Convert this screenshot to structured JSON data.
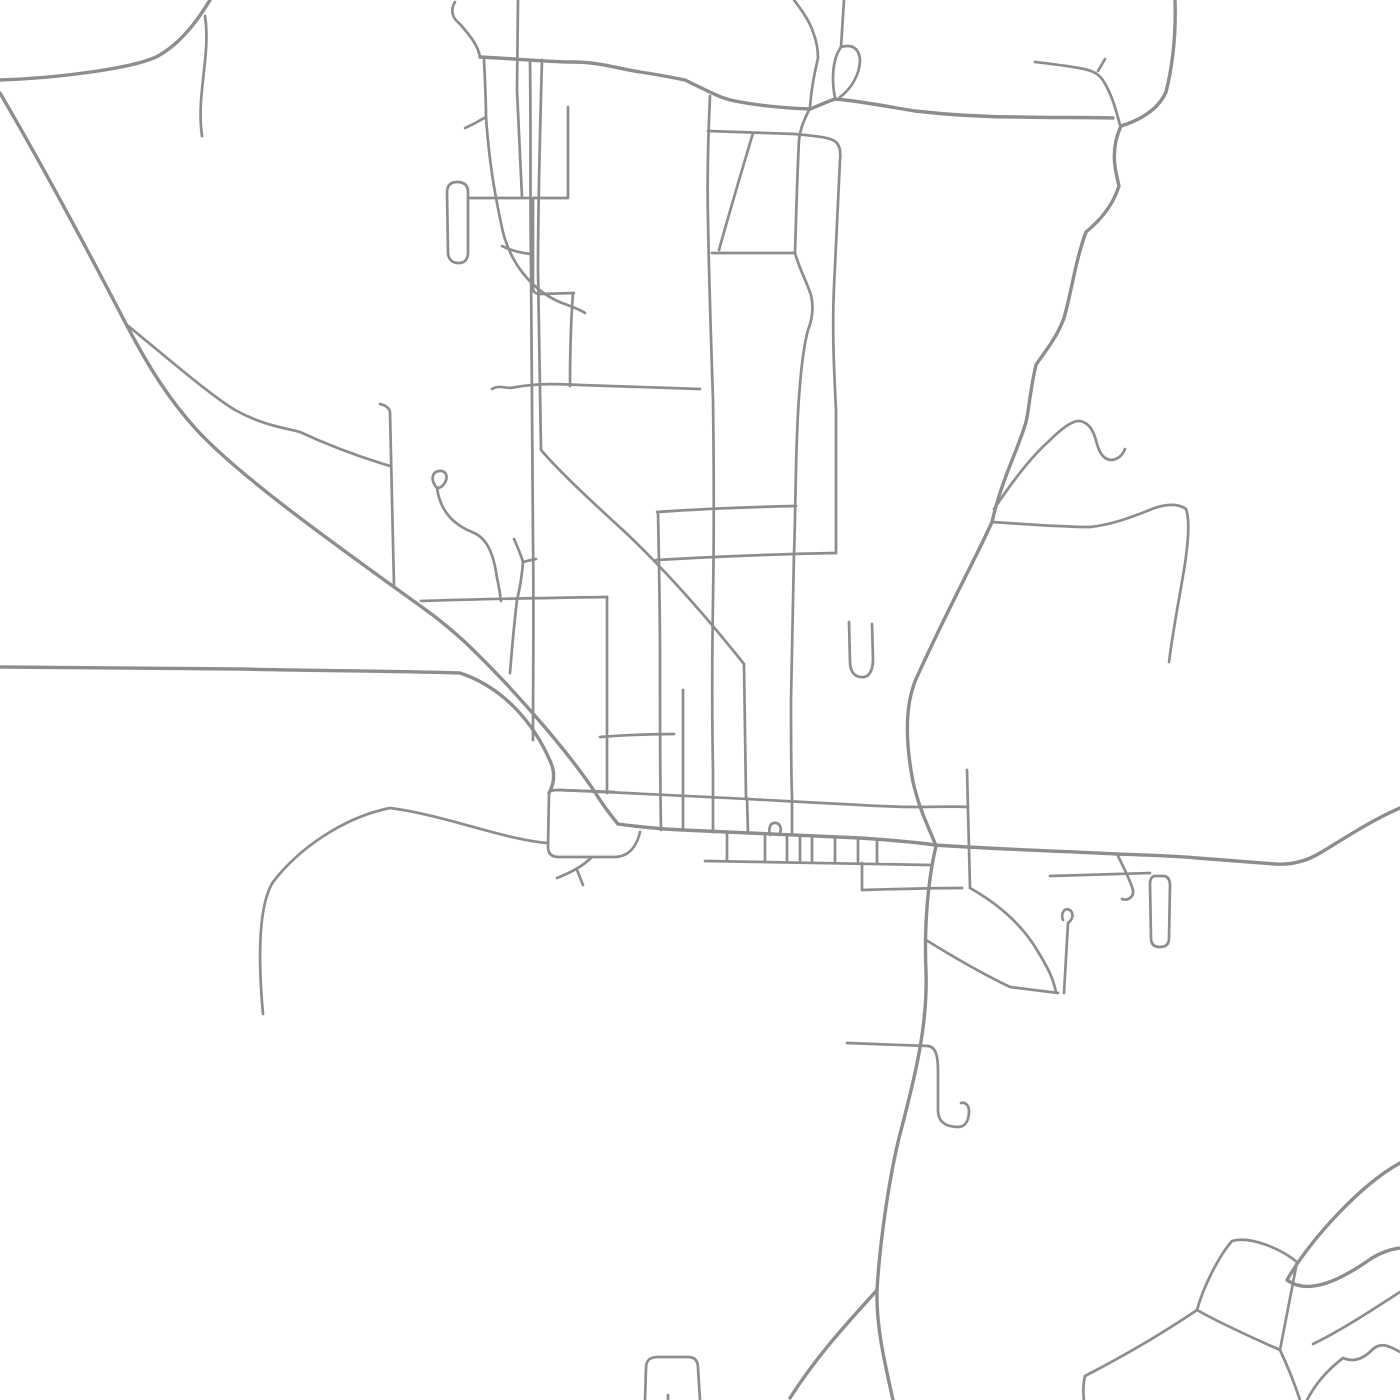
{
  "canvas": {
    "width": 1400,
    "height": 1400,
    "background": "#ffffff"
  },
  "style": {
    "stroke_color": "#8d8d8d",
    "major_width": 3.4,
    "minor_width": 2.7
  },
  "roads": [
    {
      "name": "nw-corner-road",
      "major": true,
      "d": "M 210,0 C 195,25 178,45 158,56 C 135,68 60,78 0,80"
    },
    {
      "name": "nw-stub",
      "major": false,
      "d": "M 205,16 C 211,55 196,95 202,136"
    },
    {
      "name": "long-diagonal",
      "major": true,
      "d": "M 0,93 C 45,170 85,245 125,322 C 150,370 170,400 195,428 C 240,478 350,555 430,613 C 445,624 455,633 466,643 C 520,695 575,760 600,800 C 608,812 613,818 618,824"
    },
    {
      "name": "diagonal-fork",
      "major": false,
      "d": "M 127,325 C 170,360 210,395 235,410 C 262,425 285,428 300,432 C 330,446 360,457 390,466"
    },
    {
      "name": "west-main-road",
      "major": true,
      "d": "M 0,667 C 80,667 160,668 240,669 C 330,671 400,671 460,673 C 505,688 535,725 551,763 C 556,775 553,786 549,793"
    },
    {
      "name": "southwest-road",
      "major": false,
      "d": "M 548,843 C 505,840 445,815 390,808 C 345,817 300,847 273,882 C 258,906 258,958 263,1014"
    },
    {
      "name": "block-top-west",
      "major": false,
      "d": "M 549,793 C 549,791 553,790 558,790 L 614,792"
    },
    {
      "name": "block-west-south",
      "major": false,
      "d": "M 549,793 L 548,847 C 548,854 552,857 559,857 L 616,857"
    },
    {
      "name": "block-step",
      "major": false,
      "d": "M 616,857 C 630,856 637,845 640,832"
    },
    {
      "name": "block-fork-y",
      "major": false,
      "d": "M 592,857 C 583,866 570,873 557,878 M 577,870 L 583,885"
    },
    {
      "name": "upper-town-street",
      "major": false,
      "d": "M 558,790 C 700,796 780,801 860,805 C 878,806 896,807 913,807 C 938,807 955,806 968,807"
    },
    {
      "name": "main-street",
      "major": true,
      "d": "M 618,824 C 640,827 660,829 683,830 C 740,833 800,835 860,838 C 890,840 915,842 935,845 C 990,849 1060,851 1117,854 C 1145,855 1175,856 1197,858 C 1222,860 1250,862 1275,864 C 1290,865 1305,862 1320,853 C 1345,838 1372,820 1400,808"
    },
    {
      "name": "south-row-street",
      "major": false,
      "d": "M 705,861 L 930,865"
    },
    {
      "name": "comb-1",
      "major": false,
      "d": "M 727,832 L 727,861"
    },
    {
      "name": "comb-2",
      "major": false,
      "d": "M 765,834 L 765,862"
    },
    {
      "name": "comb-3",
      "major": false,
      "d": "M 787,835 L 787,862"
    },
    {
      "name": "comb-4",
      "major": false,
      "d": "M 800,836 L 800,862"
    },
    {
      "name": "comb-5",
      "major": false,
      "d": "M 812,836 L 812,862"
    },
    {
      "name": "comb-6",
      "major": false,
      "d": "M 835,837 L 835,863"
    },
    {
      "name": "comb-7",
      "major": false,
      "d": "M 858,838 L 858,863"
    },
    {
      "name": "comb-8",
      "major": false,
      "d": "M 877,839 L 877,863"
    },
    {
      "name": "main-street-bump",
      "major": false,
      "d": "M 770,835 C 768,827 771,822 776,823 C 781,824 782,830 779,835"
    },
    {
      "name": "se-connector",
      "major": false,
      "d": "M 862,863 L 862,890 C 895,889 930,888 962,888"
    },
    {
      "name": "ne-block-east",
      "major": false,
      "d": "M 967,770 L 968,810 L 970,888"
    },
    {
      "name": "se-block-curve",
      "major": false,
      "d": "M 970,888 C 1000,905 1022,925 1037,950 C 1048,968 1053,978 1056,992"
    },
    {
      "name": "se-block-bottom",
      "major": false,
      "d": "M 926,940 C 955,958 985,975 1010,987 L 1058,993"
    },
    {
      "name": "se-block-vertical",
      "major": false,
      "d": "M 1063,920 C 1060,912 1066,906 1071,911 C 1074,915 1072,920 1068,923 L 1064,993"
    },
    {
      "name": "south-road",
      "major": true,
      "d": "M 936,846 C 928,880 924,925 926,972 C 928,1030 912,1088 899,1138 C 890,1175 880,1238 877,1290 C 876,1325 884,1360 893,1400"
    },
    {
      "name": "south-road-branch",
      "major": true,
      "d": "M 877,1290 C 858,1312 822,1348 790,1398"
    },
    {
      "name": "south-stub-west",
      "major": false,
      "d": "M 847,1043 L 928,1046"
    },
    {
      "name": "south-hook",
      "major": false,
      "d": "M 928,1046 C 936,1047 938,1056 938,1072 L 938,1110 C 938,1122 946,1127 958,1127 C 965,1127 969,1121 969,1111 C 969,1105 965,1102 961,1103"
    },
    {
      "name": "se-capsule",
      "major": false,
      "d": "M 1155,876 L 1163,876 C 1168,876 1170,880 1170,886 L 1169,938 C 1169,944 1166,947 1160,947 C 1154,947 1151,944 1151,938 L 1150,884 C 1150,879 1152,876 1155,876"
    },
    {
      "name": "se-capsule-street",
      "major": false,
      "d": "M 1050,876 L 1150,873"
    },
    {
      "name": "main-street-squiggle",
      "major": false,
      "d": "M 1117,854 C 1124,868 1130,880 1133,890 C 1134,897 1128,901 1122,899"
    },
    {
      "name": "north-winding-road",
      "major": true,
      "d": "M 1175,0 C 1176,30 1174,60 1166,92 C 1158,110 1140,120 1121,126 C 1110,150 1115,170 1119,186 C 1112,208 1098,222 1086,232 C 1075,262 1072,290 1064,318 C 1056,340 1042,355 1036,365 C 1030,390 1029,410 1026,422 C 1018,450 1002,478 992,522 C 975,560 952,600 916,679 C 905,705 905,740 913,782 C 920,812 930,830 936,846"
    },
    {
      "name": "y-west-road",
      "major": false,
      "d": "M 1035,62 C 1052,64 1070,66 1084,69 C 1094,71 1100,75 1104,82 C 1112,95 1116,110 1120,125"
    },
    {
      "name": "y-west-tick",
      "major": false,
      "d": "M 1098,71 L 1105,59"
    },
    {
      "name": "top-curl",
      "major": false,
      "d": "M 455,2 C 450,10 452,18 460,24 C 472,38 478,46 480,57"
    },
    {
      "name": "top-east-west-road",
      "major": true,
      "d": "M 480,57 C 520,59 550,62 572,62 C 600,62 615,68 640,72 C 655,74 670,77 685,80 C 710,92 720,98 735,101 C 760,106 785,108 810,109 C 818,106 826,102 835,99 C 860,101 890,107 915,111 C 950,115 990,117 1020,117 C 1055,118 1085,117 1113,118"
    },
    {
      "name": "loop-west-side",
      "major": false,
      "d": "M 835,98 C 831,78 833,58 841,47"
    },
    {
      "name": "loop-east-side",
      "major": false,
      "d": "M 841,47 C 852,44 859,48 860,60 C 860,75 850,90 840,97"
    },
    {
      "name": "loop-stem",
      "major": false,
      "d": "M 841,47 L 844,0"
    },
    {
      "name": "church-street",
      "major": false,
      "d": "M 794,0 C 803,12 810,22 813,32 C 817,42 818,50 818,58 C 814,75 811,90 810,108 C 803,122 800,130 799,140 C 797,180 796,220 795,253 C 799,268 806,280 811,295 C 814,308 812,320 808,330 C 800,360 797,420 796,470 C 795,510 795,530 794,553 C 793,600 792,650 791,700 C 791,740 791,770 792,798 L 792,833"
    },
    {
      "name": "center-avenue",
      "major": false,
      "d": "M 710,96 C 708,140 707,180 708,220 C 709,280 711,340 713,400 C 714,470 714,540 713,600 C 712,660 712,720 713,770 L 713,832"
    },
    {
      "name": "west-avenue",
      "major": false,
      "d": "M 530,60 C 531,130 530,200 531,270 C 532,360 532,450 533,540 C 534,610 533,680 533,740"
    },
    {
      "name": "second-diagonal",
      "major": false,
      "d": "M 542,60 C 540,130 538,200 538,270 C 539,340 540,400 541,450 C 560,472 590,500 625,532 C 665,570 705,615 744,664 L 746,798"
    },
    {
      "name": "west-capsule",
      "major": false,
      "d": "M 457,182 C 450,182 447,186 447,193 L 448,252 C 448,259 452,263 459,263 C 465,263 468,259 468,252 L 468,192 C 468,185 464,182 457,182"
    },
    {
      "name": "capsule-connector",
      "major": false,
      "d": "M 468,198 L 530,198"
    },
    {
      "name": "north-west-vertical",
      "major": false,
      "d": "M 518,0 L 517,90 L 520,155 L 522,197"
    },
    {
      "name": "l-street-1",
      "major": false,
      "d": "M 568,107 L 568,198 L 534,198"
    },
    {
      "name": "l-street-2",
      "major": false,
      "d": "M 533,198 L 533,288 C 533,292 536,294 540,294 L 574,293"
    },
    {
      "name": "l-street-3",
      "major": false,
      "d": "M 573,293 C 571,320 570,350 570,386"
    },
    {
      "name": "mid-west-street",
      "major": false,
      "d": "M 492,389 C 500,384 508,390 516,387 C 540,383 560,384 580,385 L 700,389"
    },
    {
      "name": "wiggle-road",
      "major": false,
      "d": "M 484,60 C 485,80 486,100 486,117 C 489,160 494,190 501,223 C 508,262 532,291 562,303 C 573,307 581,310 585,313"
    },
    {
      "name": "wiggle-fork",
      "major": false,
      "d": "M 486,117 C 479,121 472,125 465,128"
    },
    {
      "name": "grid-street-130",
      "major": false,
      "d": "M 708,131 L 795,134"
    },
    {
      "name": "block-right-edge",
      "major": false,
      "d": "M 795,134 C 815,136 830,137 836,142 C 840,146 841,152 840,160 L 834,287 C 832,330 834,370 836,410 L 836,553"
    },
    {
      "name": "grid-street-253",
      "major": false,
      "d": "M 712,253 L 795,253"
    },
    {
      "name": "grid-street-253-west",
      "major": false,
      "d": "M 502,246 C 512,251 521,253 531,254"
    },
    {
      "name": "slant-street",
      "major": false,
      "d": "M 753,133 C 742,170 730,210 719,250"
    },
    {
      "name": "grid-street-512",
      "major": false,
      "d": "M 657,512 C 700,509 750,507 796,506"
    },
    {
      "name": "grid-street-558",
      "major": false,
      "d": "M 656,560 C 710,557 770,554 836,553"
    },
    {
      "name": "grid-street-600",
      "major": false,
      "d": "M 421,601 C 480,599 540,598 607,597"
    },
    {
      "name": "grid-street-735",
      "major": false,
      "d": "M 600,737 C 625,735 650,734 674,734"
    },
    {
      "name": "vertical-607",
      "major": false,
      "d": "M 607,597 L 607,793"
    },
    {
      "name": "vertical-658",
      "major": false,
      "d": "M 658,512 C 659,560 660,610 660,660 C 660,720 660,780 661,830"
    },
    {
      "name": "vertical-683",
      "major": false,
      "d": "M 683,690 L 683,830"
    },
    {
      "name": "vertical-747",
      "major": false,
      "d": "M 747,798 L 748,833"
    },
    {
      "name": "balloon-loop-street",
      "major": false,
      "d": "M 437,488 C 430,480 432,472 439,471 C 446,470 449,477 444,484 C 442,487 439,488 437,488 C 440,510 452,524 472,532 C 488,538 494,556 497,578 C 499,586 500,594 501,601"
    },
    {
      "name": "hooked-connector",
      "major": false,
      "d": "M 514,539 C 518,548 521,555 523,562 C 522,575 520,588 517,600 C 514,625 512,648 510,673"
    },
    {
      "name": "hooked-connector-branch",
      "major": false,
      "d": "M 523,562 C 527,561 531,560 536,559"
    },
    {
      "name": "vertical-390",
      "major": false,
      "d": "M 380,404 C 385,405 389,407 390,412 L 392,500 L 394,585"
    },
    {
      "name": "ne-squiggle",
      "major": false,
      "d": "M 994,509 C 1010,485 1030,458 1048,442 C 1060,430 1072,420 1080,421 C 1090,423 1094,432 1097,444 C 1100,455 1105,460 1112,460 C 1119,459 1123,454 1125,449"
    },
    {
      "name": "east-loop-road",
      "major": false,
      "d": "M 992,522 C 1025,524 1060,527 1090,527 C 1110,525 1130,518 1152,509 C 1165,504 1178,503 1186,509 C 1190,520 1188,545 1184,570 C 1179,600 1173,630 1169,662"
    },
    {
      "name": "cul-de-sac-u",
      "major": false,
      "d": "M 849,622 L 850,662 C 850,673 856,678 864,677 C 870,676 873,669 873,659 L 872,624"
    },
    {
      "name": "south-block-left",
      "major": false,
      "d": "M 645,1400 L 646,1368 C 646,1360 650,1357 658,1357 L 688,1357 C 695,1357 698,1361 698,1368 L 700,1400"
    },
    {
      "name": "south-block-tick",
      "major": false,
      "d": "M 668,1395 L 668,1400"
    },
    {
      "name": "sr-outer-band",
      "major": true,
      "d": "M 1400,1163 C 1360,1185 1310,1240 1287,1280 C 1310,1297 1345,1277 1372,1258 C 1382,1252 1392,1249 1400,1248"
    },
    {
      "name": "sr-square",
      "major": false,
      "d": "M 1232,1241 C 1250,1236 1280,1248 1297,1262 L 1280,1350 C 1262,1342 1218,1322 1197,1310 C 1203,1288 1218,1257 1232,1241"
    },
    {
      "name": "sr-spur-west",
      "major": false,
      "d": "M 1197,1310 C 1160,1335 1120,1358 1085,1376 C 1083,1384 1083,1392 1084,1400"
    },
    {
      "name": "sr-spur-south",
      "major": false,
      "d": "M 1280,1350 C 1288,1367 1295,1385 1300,1400"
    },
    {
      "name": "sr-inner-band",
      "major": false,
      "d": "M 1400,1292 C 1372,1310 1342,1330 1313,1344"
    },
    {
      "name": "sr-bumpy-road",
      "major": false,
      "d": "M 1400,1352 C 1388,1345 1380,1342 1372,1350 C 1362,1360 1352,1362 1343,1358 C 1325,1372 1315,1385 1307,1400"
    }
  ]
}
